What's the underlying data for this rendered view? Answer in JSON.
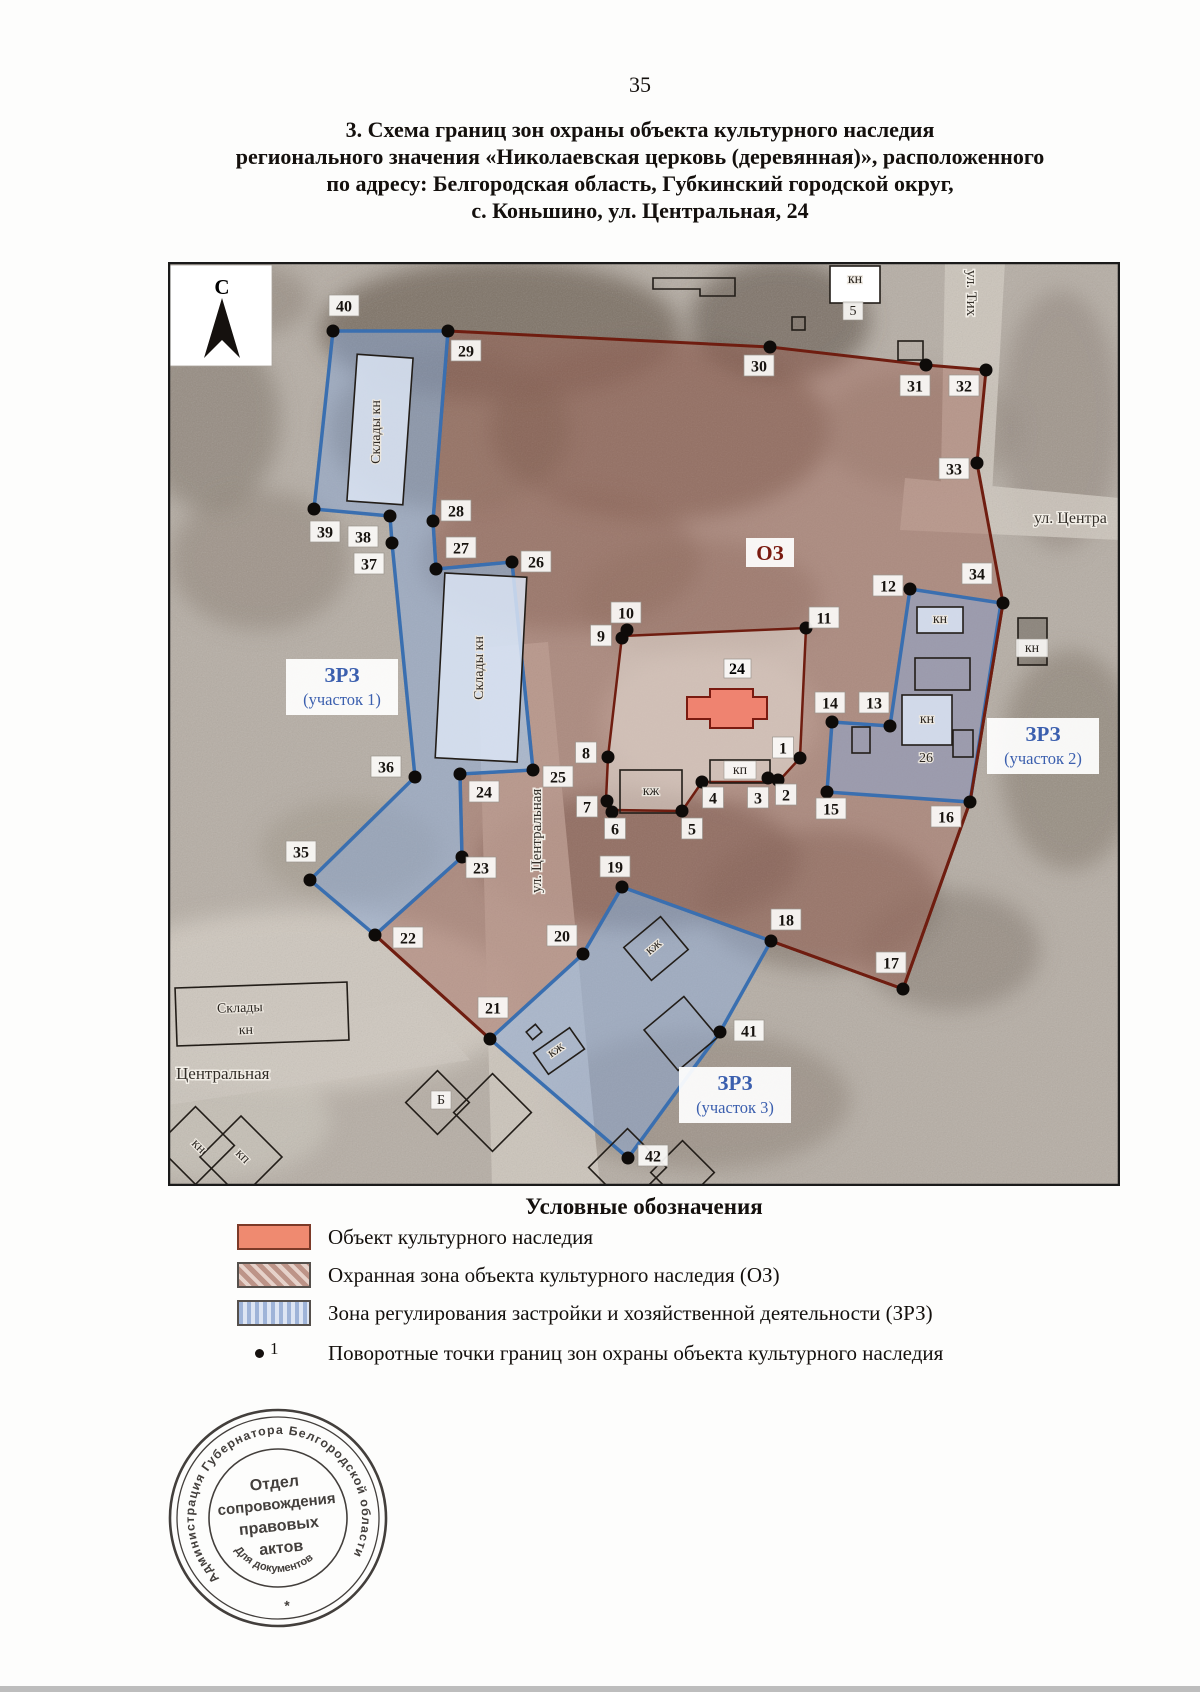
{
  "page": {
    "number": "35"
  },
  "title": {
    "lines": [
      "3. Схема границ зон охраны объекта культурного наследия",
      "регионального значения «Николаевская церковь (деревянная)», расположенного",
      "по адресу: Белгородская область, Губкинский городской округ,",
      "с. Коньшино, ул. Центральная, 24"
    ]
  },
  "map": {
    "north_label": "С",
    "oz_label": {
      "text": "ОЗ",
      "x": 770,
      "y": 553
    },
    "object_label": {
      "text": "24",
      "x": 737,
      "y": 668
    },
    "zone_area_labels": [
      {
        "line1": "ЗРЗ",
        "line2": "(участок 1)",
        "x": 342,
        "y": 688
      },
      {
        "line1": "ЗРЗ",
        "line2": "(участок 2)",
        "x": 1043,
        "y": 747
      },
      {
        "line1": "ЗРЗ",
        "line2": "(участок 3)",
        "x": 735,
        "y": 1096
      }
    ],
    "street_labels": [
      {
        "text": "ул. Тих",
        "x": 967,
        "y": 270,
        "rot": 90,
        "size": 15
      },
      {
        "text": "ул. Центра",
        "x": 1034,
        "y": 523,
        "rot": 0,
        "size": 16
      },
      {
        "text": "ул. Центральная",
        "x": 541,
        "y": 893,
        "rot": -90,
        "size": 15
      },
      {
        "text": "Центральная",
        "x": 176,
        "y": 1079,
        "rot": 0,
        "size": 17
      }
    ],
    "building_labels": [
      {
        "text": "Склады кн",
        "x": 380,
        "y": 432,
        "rot": -90
      },
      {
        "text": "Склады кн",
        "x": 483,
        "y": 668,
        "rot": -90
      },
      {
        "text": "Склады",
        "x": 240,
        "y": 1012,
        "rot": -2
      },
      {
        "text": "кн",
        "x": 246,
        "y": 1034,
        "rot": -2
      },
      {
        "text": "кн",
        "x": 855,
        "y": 283,
        "rot": 0
      },
      {
        "text": "5",
        "x": 853,
        "y": 315,
        "rot": 0,
        "box": true
      },
      {
        "text": "кн",
        "x": 940,
        "y": 623,
        "rot": 0
      },
      {
        "text": "кн",
        "x": 927,
        "y": 723,
        "rot": 0
      },
      {
        "text": "кн",
        "x": 1032,
        "y": 652,
        "rot": 0,
        "box": true
      },
      {
        "text": "26",
        "x": 926,
        "y": 762,
        "rot": 0
      },
      {
        "text": "кж",
        "x": 651,
        "y": 795,
        "rot": 0
      },
      {
        "text": "кп",
        "x": 740,
        "y": 774,
        "rot": 0,
        "box": true
      },
      {
        "text": "кж",
        "x": 656,
        "y": 950,
        "rot": -40
      },
      {
        "text": "кж",
        "x": 558,
        "y": 1053,
        "rot": -35
      },
      {
        "text": "Б",
        "x": 441,
        "y": 1104,
        "rot": 0,
        "box": true
      },
      {
        "text": "кн",
        "x": 196,
        "y": 1149,
        "rot": 45
      },
      {
        "text": "кп",
        "x": 240,
        "y": 1159,
        "rot": 45
      }
    ],
    "points": [
      {
        "n": "1",
        "x": 800,
        "y": 758,
        "lx": 783,
        "ly": 748
      },
      {
        "n": "2",
        "x": 778,
        "y": 780,
        "lx": 786,
        "ly": 795
      },
      {
        "n": "3",
        "x": 768,
        "y": 778,
        "lx": 758,
        "ly": 798
      },
      {
        "n": "4",
        "x": 702,
        "y": 782,
        "lx": 713,
        "ly": 798
      },
      {
        "n": "5",
        "x": 682,
        "y": 811,
        "lx": 692,
        "ly": 829
      },
      {
        "n": "6",
        "x": 612,
        "y": 812,
        "lx": 615,
        "ly": 829
      },
      {
        "n": "7",
        "x": 607,
        "y": 801,
        "lx": 587,
        "ly": 807
      },
      {
        "n": "8",
        "x": 608,
        "y": 757,
        "lx": 586,
        "ly": 753
      },
      {
        "n": "9",
        "x": 622,
        "y": 638,
        "lx": 601,
        "ly": 636
      },
      {
        "n": "10",
        "x": 627,
        "y": 630,
        "lx": 626,
        "ly": 613
      },
      {
        "n": "11",
        "x": 806,
        "y": 628,
        "lx": 824,
        "ly": 618
      },
      {
        "n": "12",
        "x": 910,
        "y": 589,
        "lx": 888,
        "ly": 586
      },
      {
        "n": "13",
        "x": 890,
        "y": 726,
        "lx": 874,
        "ly": 703
      },
      {
        "n": "14",
        "x": 832,
        "y": 722,
        "lx": 830,
        "ly": 703
      },
      {
        "n": "15",
        "x": 827,
        "y": 792,
        "lx": 831,
        "ly": 809
      },
      {
        "n": "16",
        "x": 970,
        "y": 802,
        "lx": 946,
        "ly": 817
      },
      {
        "n": "17",
        "x": 903,
        "y": 989,
        "lx": 891,
        "ly": 963
      },
      {
        "n": "18",
        "x": 771,
        "y": 941,
        "lx": 786,
        "ly": 920
      },
      {
        "n": "19",
        "x": 622,
        "y": 887,
        "lx": 615,
        "ly": 867
      },
      {
        "n": "20",
        "x": 583,
        "y": 954,
        "lx": 562,
        "ly": 936
      },
      {
        "n": "21",
        "x": 490,
        "y": 1039,
        "lx": 493,
        "ly": 1008
      },
      {
        "n": "22",
        "x": 375,
        "y": 935,
        "lx": 408,
        "ly": 938
      },
      {
        "n": "23",
        "x": 462,
        "y": 857,
        "lx": 481,
        "ly": 868
      },
      {
        "n": "24",
        "x": 460,
        "y": 774,
        "lx": 484,
        "ly": 792
      },
      {
        "n": "25",
        "x": 533,
        "y": 770,
        "lx": 558,
        "ly": 777
      },
      {
        "n": "26",
        "x": 512,
        "y": 562,
        "lx": 536,
        "ly": 562
      },
      {
        "n": "27",
        "x": 436,
        "y": 569,
        "lx": 461,
        "ly": 548
      },
      {
        "n": "28",
        "x": 433,
        "y": 521,
        "lx": 456,
        "ly": 511
      },
      {
        "n": "29",
        "x": 448,
        "y": 331,
        "lx": 466,
        "ly": 351
      },
      {
        "n": "30",
        "x": 770,
        "y": 347,
        "lx": 759,
        "ly": 366
      },
      {
        "n": "31",
        "x": 926,
        "y": 365,
        "lx": 915,
        "ly": 386
      },
      {
        "n": "32",
        "x": 986,
        "y": 370,
        "lx": 964,
        "ly": 386
      },
      {
        "n": "33",
        "x": 977,
        "y": 463,
        "lx": 954,
        "ly": 469
      },
      {
        "n": "34",
        "x": 1003,
        "y": 603,
        "lx": 977,
        "ly": 574
      },
      {
        "n": "35",
        "x": 310,
        "y": 880,
        "lx": 301,
        "ly": 852
      },
      {
        "n": "36",
        "x": 415,
        "y": 777,
        "lx": 386,
        "ly": 767
      },
      {
        "n": "37",
        "x": 392,
        "y": 543,
        "lx": 369,
        "ly": 564
      },
      {
        "n": "38",
        "x": 390,
        "y": 516,
        "lx": 363,
        "ly": 537
      },
      {
        "n": "39",
        "x": 314,
        "y": 509,
        "lx": 325,
        "ly": 532
      },
      {
        "n": "40",
        "x": 333,
        "y": 331,
        "lx": 344,
        "ly": 306
      },
      {
        "n": "41",
        "x": 720,
        "y": 1032,
        "lx": 749,
        "ly": 1031
      },
      {
        "n": "42",
        "x": 628,
        "y": 1158,
        "lx": 653,
        "ly": 1156
      }
    ]
  },
  "legend": {
    "title": "Условные обозначения",
    "items": [
      {
        "swatch": "object",
        "label": "Объект культурного наследия"
      },
      {
        "swatch": "oz",
        "label": "Охранная зона объекта культурного наследия (ОЗ)"
      },
      {
        "swatch": "zrz",
        "label": "Зона регулирования застройки и хозяйственной деятельности (ЗРЗ)"
      },
      {
        "swatch": "point",
        "label": "Поворотные точки границ зон охраны объекта культурного наследия",
        "symbol_number": "1"
      }
    ]
  },
  "stamp": {
    "ring_text": "Администрация Губернатора Белгородской области",
    "bottom_symbol": "*",
    "inner_arc_text": "Для документов",
    "center_lines": [
      "Отдел",
      "сопровождения",
      "правовых",
      "актов"
    ]
  },
  "colors": {
    "oz_boundary": "#6f1d10",
    "oz_wash": "rgba(160,95,80,0.42)",
    "zrz_stroke": "#3a6fb0",
    "zrz_wash": "rgba(140,170,215,0.5)",
    "heritage_object_fill": "#ef8370",
    "zone_label_blue": "#3b5fae",
    "point_dot": "#0e0b09"
  }
}
